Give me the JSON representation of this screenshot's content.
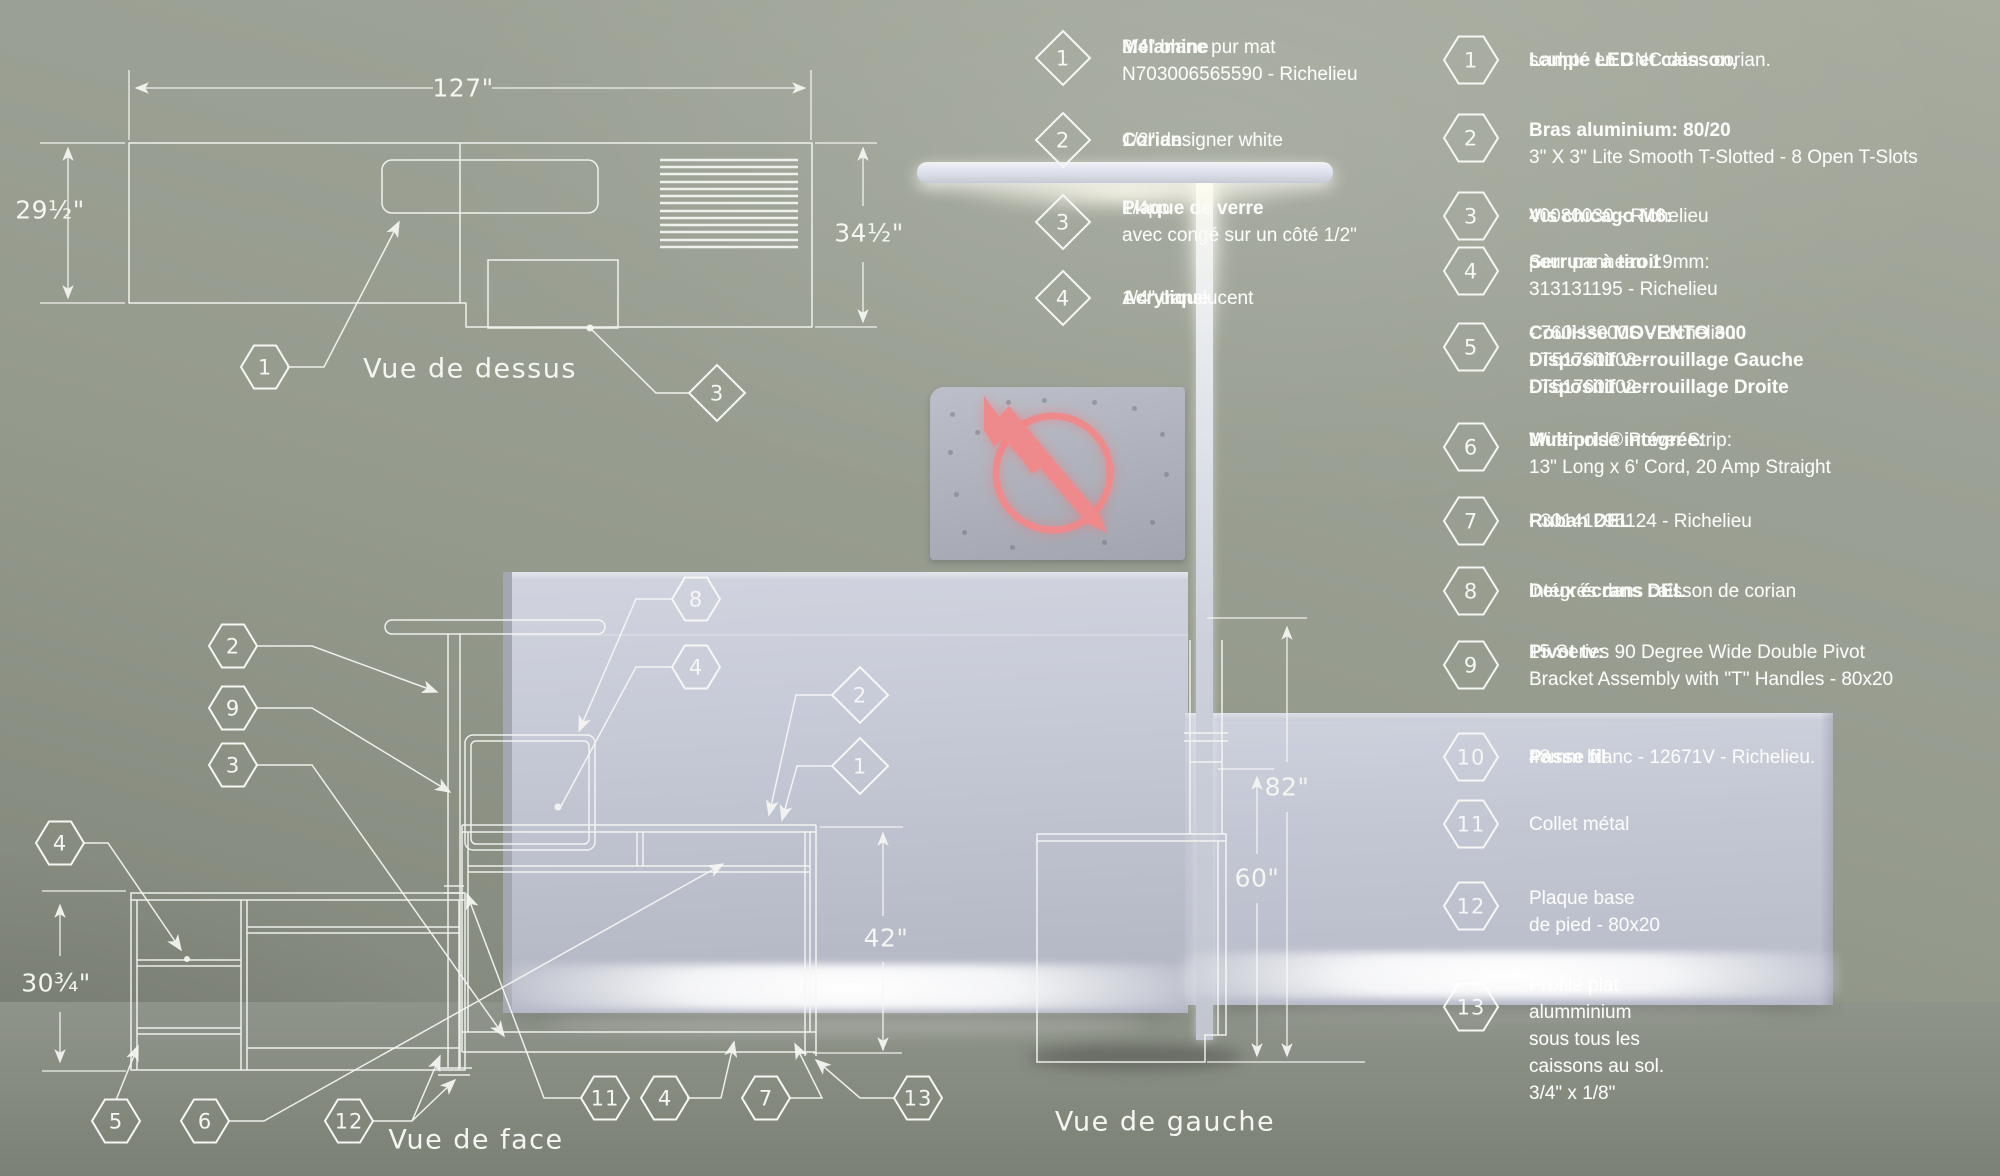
{
  "views": {
    "top": "Vue de dessus",
    "front": "Vue de face",
    "left": "Vue de gauche"
  },
  "dimensions": [
    {
      "id": "plan-width",
      "label": "127\"",
      "x": 463,
      "y": 88
    },
    {
      "id": "plan-depth-left",
      "label": "29½\"",
      "x": 50,
      "y": 210
    },
    {
      "id": "plan-depth-right",
      "label": "34½\"",
      "x": 869,
      "y": 233
    },
    {
      "id": "cabinet-height",
      "label": "30¾\"",
      "x": 56,
      "y": 983
    },
    {
      "id": "counter-height",
      "label": "42\"",
      "x": 886,
      "y": 938
    },
    {
      "id": "screen-height",
      "label": "60\"",
      "x": 1257,
      "y": 878
    },
    {
      "id": "lamp-height",
      "label": "82\"",
      "x": 1287,
      "y": 787
    }
  ],
  "legend_diamonds": [
    {
      "num": "1",
      "y": 58,
      "ty": 34,
      "lines": [
        [
          {
            "b": "Mélamine"
          },
          {
            "t": " 3/4\" blanc pur mat"
          }
        ],
        [
          {
            "t": "N703006565590 - Richelieu"
          }
        ]
      ]
    },
    {
      "num": "2",
      "y": 140,
      "lines": [
        [
          {
            "b": "Corian"
          },
          {
            "t": " 1/2\" designer white"
          }
        ]
      ]
    },
    {
      "num": "3",
      "y": 222,
      "ty": 195,
      "lines": [
        [
          {
            "b": "Plaque de verre"
          },
          {
            "t": " 1/4po"
          }
        ],
        [
          {
            "t": "avec congé sur un côté 1/2\""
          }
        ]
      ]
    },
    {
      "num": "4",
      "y": 298,
      "lines": [
        [
          {
            "b": "Acrylique"
          },
          {
            "t": " 1/4\" translucent"
          }
        ]
      ]
    }
  ],
  "legend_hexes": [
    {
      "num": "1",
      "y": 60,
      "lines": [
        [
          {
            "b": "Lampe LED et caisson,"
          },
          {
            "t": "sculpté en CNC dans corian."
          }
        ]
      ]
    },
    {
      "num": "2",
      "y": 138,
      "ty": 117,
      "lines": [
        [
          {
            "b": "Bras aluminium: 80/20"
          }
        ],
        [
          {
            "t": "3\" X 3\" Lite Smooth T-Slotted - 8 Open T-Slots"
          }
        ]
      ]
    },
    {
      "num": "3",
      "y": 216,
      "lines": [
        [
          {
            "b": "Vis chicago M6:"
          },
          {
            "t": " 40080030 - Richelieu"
          }
        ]
      ]
    },
    {
      "num": "4",
      "y": 271,
      "ty": 249,
      "lines": [
        [
          {
            "b": "Serrure à tiroir"
          },
          {
            "t": " pour panneau 19mm:"
          }
        ],
        [
          {
            "t": "313131195 - Richelieu"
          }
        ]
      ]
    },
    {
      "num": "5",
      "y": 347,
      "ty": 320,
      "lines": [
        [
          {
            "b": "Coulisse MOVENTO 300"
          },
          {
            "t": " - 760H3000S - Richelieu"
          }
        ],
        [
          {
            "b": "Dispositif verrouillage Gauche"
          },
          {
            "t": " - T51760103 -"
          }
        ],
        [
          {
            "b": "Dispositif verrouillage Droite"
          },
          {
            "t": " - T51760102 -"
          }
        ]
      ]
    },
    {
      "num": "6",
      "y": 447,
      "ty": 427,
      "lines": [
        [
          {
            "b": "Multiprise intégrée:"
          },
          {
            "t": " Wiremold® Power Strip:"
          }
        ],
        [
          {
            "t": "13\" Long x 6' Cord, 20 Amp Straight"
          }
        ]
      ]
    },
    {
      "num": "7",
      "y": 521,
      "lines": [
        [
          {
            "b": "Ruban DEL"
          },
          {
            "t": " - 30141296124 - Richelieu"
          }
        ]
      ]
    },
    {
      "num": "8",
      "y": 591,
      "lines": [
        [
          {
            "b": "Deux écrans DEL"
          },
          {
            "t": " intégrés dans caisson de corian"
          }
        ]
      ]
    },
    {
      "num": "9",
      "y": 665,
      "ty": 639,
      "lines": [
        [
          {
            "b": "Pivot tv:"
          },
          {
            "t": " 15 Series 90 Degree Wide Double Pivot"
          }
        ],
        [
          {
            "t": "Bracket Assembly with \"T\" Handles - 80x20"
          }
        ]
      ]
    },
    {
      "num": "10",
      "y": 757,
      "lines": [
        [
          {
            "b": "Passe fil"
          },
          {
            "t": "  48mm blanc - 12671V - Richelieu."
          }
        ]
      ]
    },
    {
      "num": "11",
      "y": 824,
      "lines": [
        [
          {
            "t": "Collet métal"
          }
        ]
      ]
    },
    {
      "num": "12",
      "y": 906,
      "ty": 885,
      "lines": [
        [
          {
            "t": "Plaque base"
          }
        ],
        [
          {
            "t": "de pied - 80x20"
          }
        ]
      ]
    },
    {
      "num": "13",
      "y": 1007,
      "ty": 972,
      "lines": [
        [
          {
            "t": "Profile plat"
          }
        ],
        [
          {
            "t": "alumminium"
          }
        ],
        [
          {
            "t": "sous tous les"
          }
        ],
        [
          {
            "t": "caissons au sol."
          }
        ],
        [
          {
            "t": "3/4\" x 1/8\""
          }
        ]
      ]
    }
  ],
  "drawing_callouts": [
    {
      "shape": "hex",
      "num": "1",
      "x": 265,
      "y": 367
    },
    {
      "shape": "diamond",
      "num": "3",
      "x": 717,
      "y": 393
    },
    {
      "shape": "hex",
      "num": "2",
      "x": 233,
      "y": 646
    },
    {
      "shape": "hex",
      "num": "9",
      "x": 233,
      "y": 708
    },
    {
      "shape": "hex",
      "num": "3",
      "x": 233,
      "y": 765
    },
    {
      "shape": "hex",
      "num": "4",
      "x": 60,
      "y": 843
    },
    {
      "shape": "hex",
      "num": "5",
      "x": 116,
      "y": 1121
    },
    {
      "shape": "hex",
      "num": "6",
      "x": 205,
      "y": 1121
    },
    {
      "shape": "hex",
      "num": "12",
      "x": 349,
      "y": 1121
    },
    {
      "shape": "hex",
      "num": "8",
      "x": 696,
      "y": 599
    },
    {
      "shape": "hex",
      "num": "4",
      "x": 696,
      "y": 667
    },
    {
      "shape": "diamond",
      "num": "2",
      "x": 860,
      "y": 695
    },
    {
      "shape": "diamond",
      "num": "1",
      "x": 860,
      "y": 766
    },
    {
      "shape": "hex",
      "num": "11",
      "x": 605,
      "y": 1098
    },
    {
      "shape": "hex",
      "num": "4",
      "x": 665,
      "y": 1098
    },
    {
      "shape": "hex",
      "num": "7",
      "x": 766,
      "y": 1098
    },
    {
      "shape": "hex",
      "num": "13",
      "x": 918,
      "y": 1098
    }
  ],
  "colors": {
    "line": "#f6f7f4",
    "logo": "#ee8a8c",
    "led": "#ffffff"
  }
}
